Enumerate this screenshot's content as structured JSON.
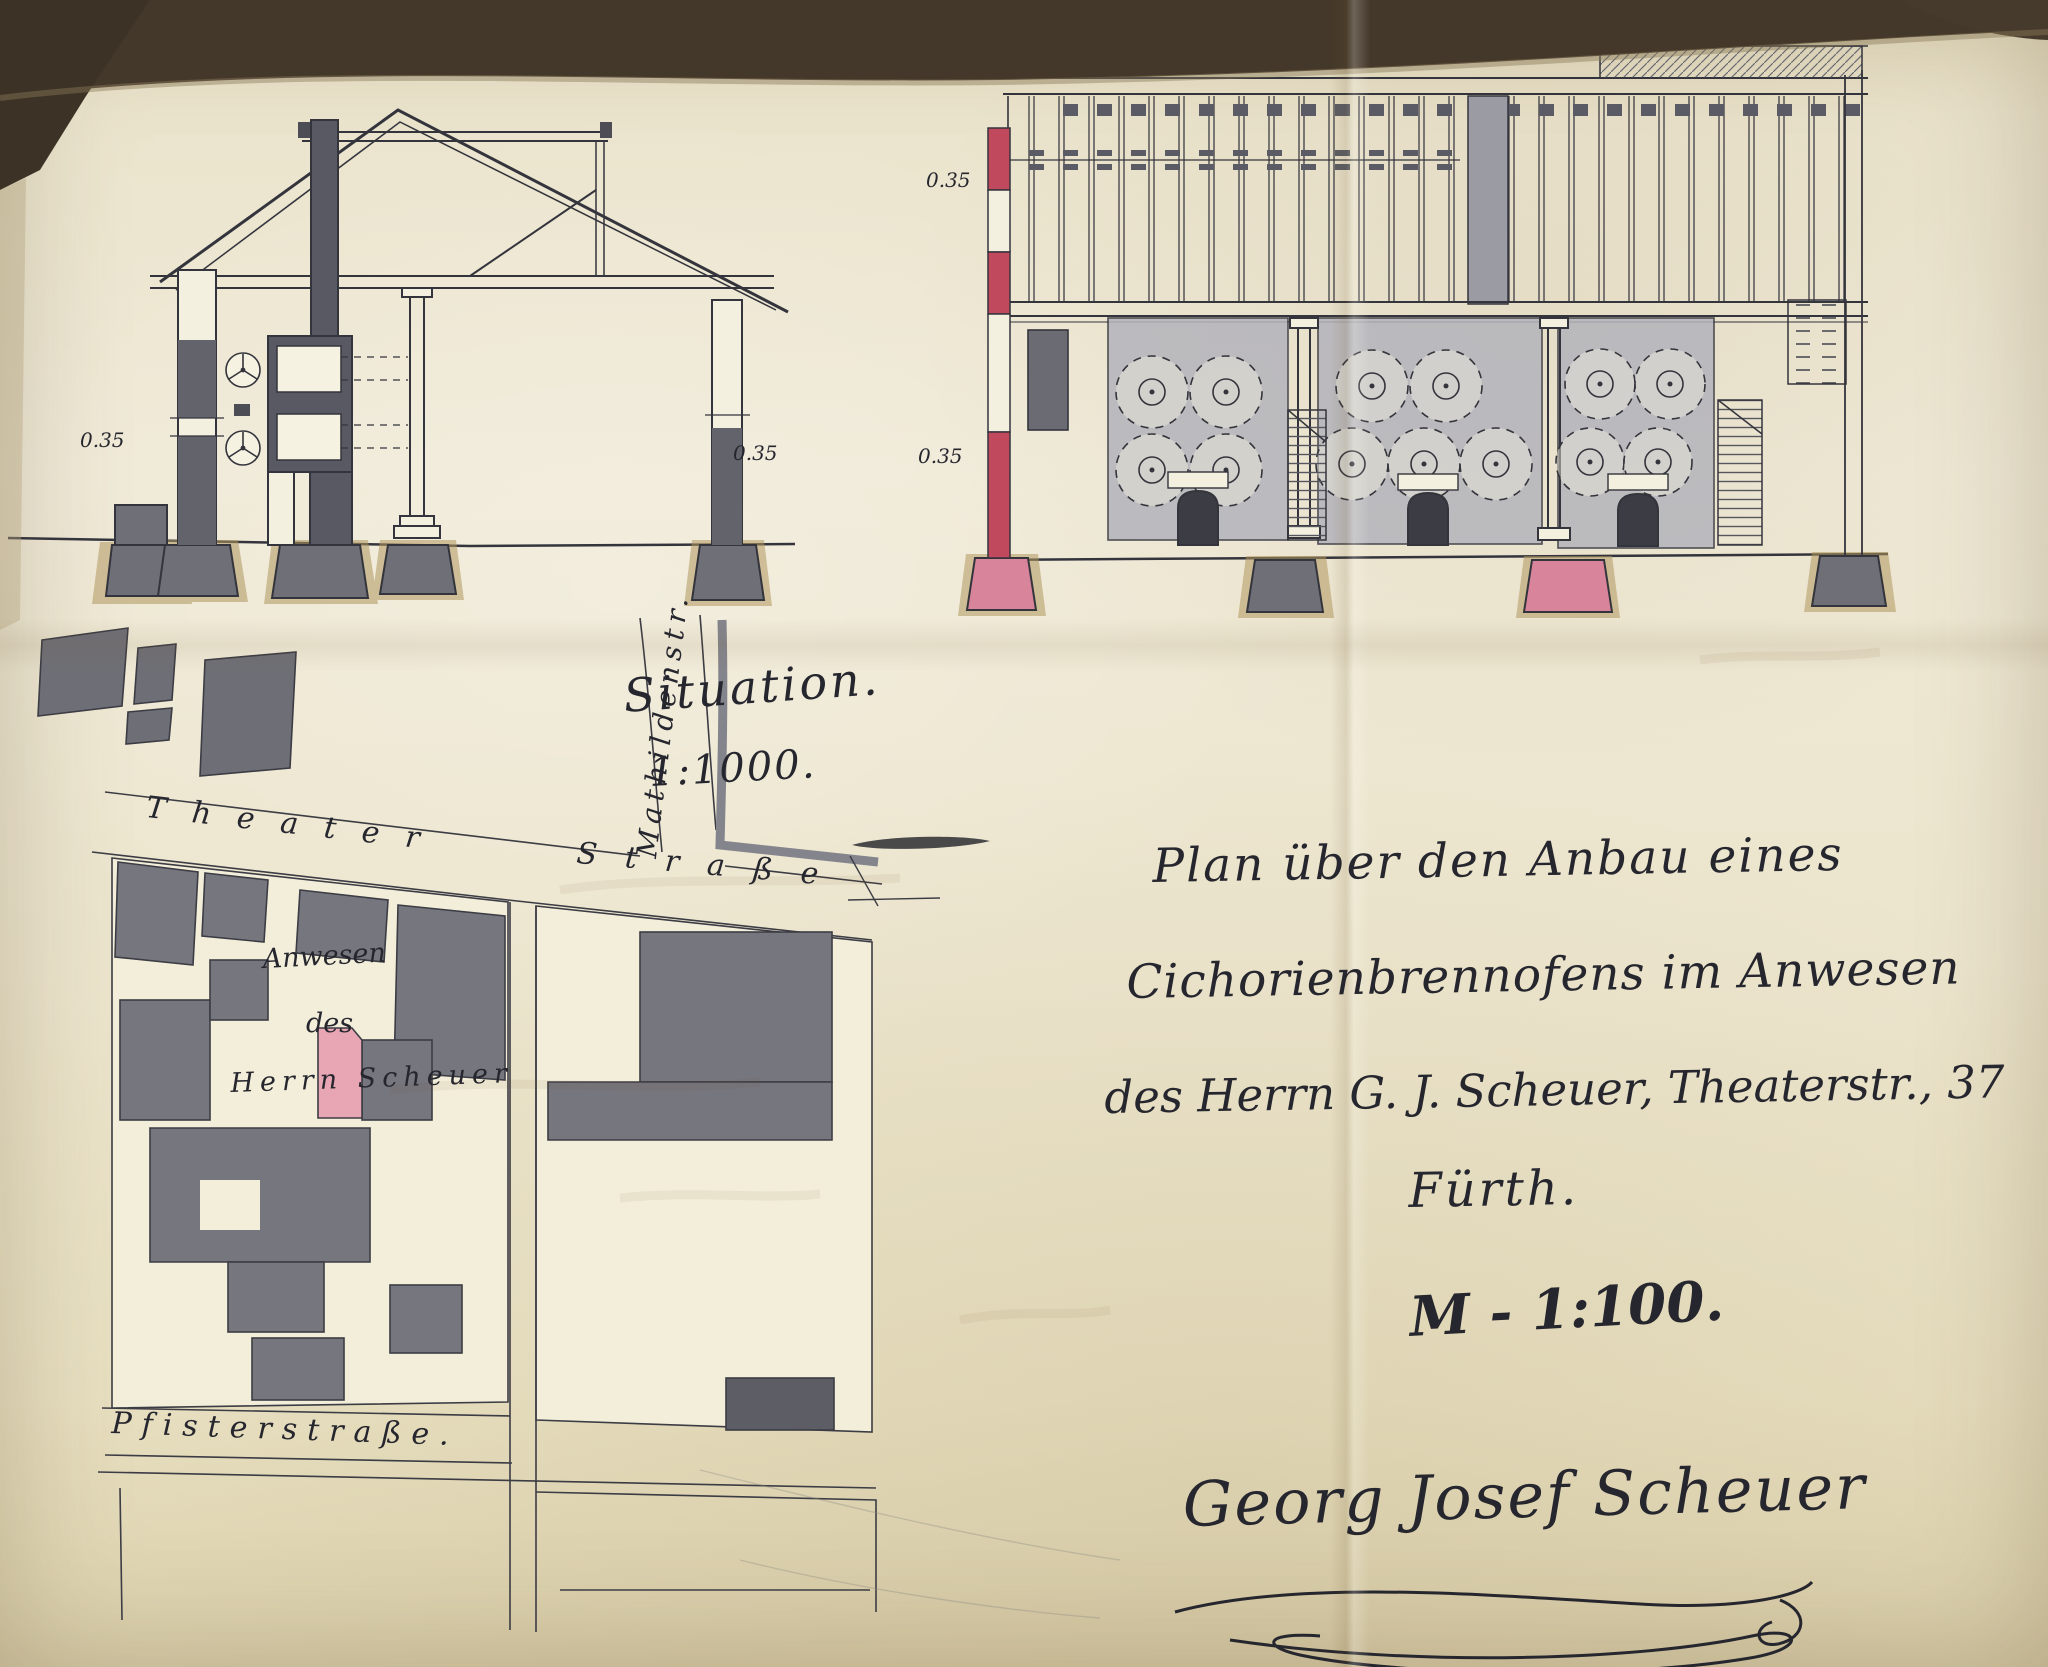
{
  "dimensions": [
    "0.35",
    "0.35",
    "0.35",
    "0.35"
  ],
  "situation": {
    "title": "Situation.",
    "scale": "1:1000."
  },
  "map": {
    "street_theater": "Theater",
    "street_strasse": "Straße",
    "street_mathilden": "Mathildenstr.",
    "street_pfister": "Pfisterstraße.",
    "property": {
      "line1": "Anwesen",
      "line2": "des",
      "line3": "Herrn Scheuer"
    }
  },
  "title_block": {
    "line1": "Plan über den Anbau eines",
    "line2": "Cichorienbrennofens im Anwesen",
    "line3": "des Herrn G. J. Scheuer, Theaterstr., 37",
    "line4": "Fürth.",
    "scale_note": "M - 1:100.",
    "signature": "Georg Josef Scheuer"
  },
  "colors": {
    "paper": "#ece5cf",
    "ink": "#2c2c34",
    "wall_gray": "#61626a",
    "panel_gray": "#b3b3bb",
    "accent_red": "#c0495e",
    "accent_pink": "#e8a6b4",
    "footing_tan": "#b0985f"
  }
}
